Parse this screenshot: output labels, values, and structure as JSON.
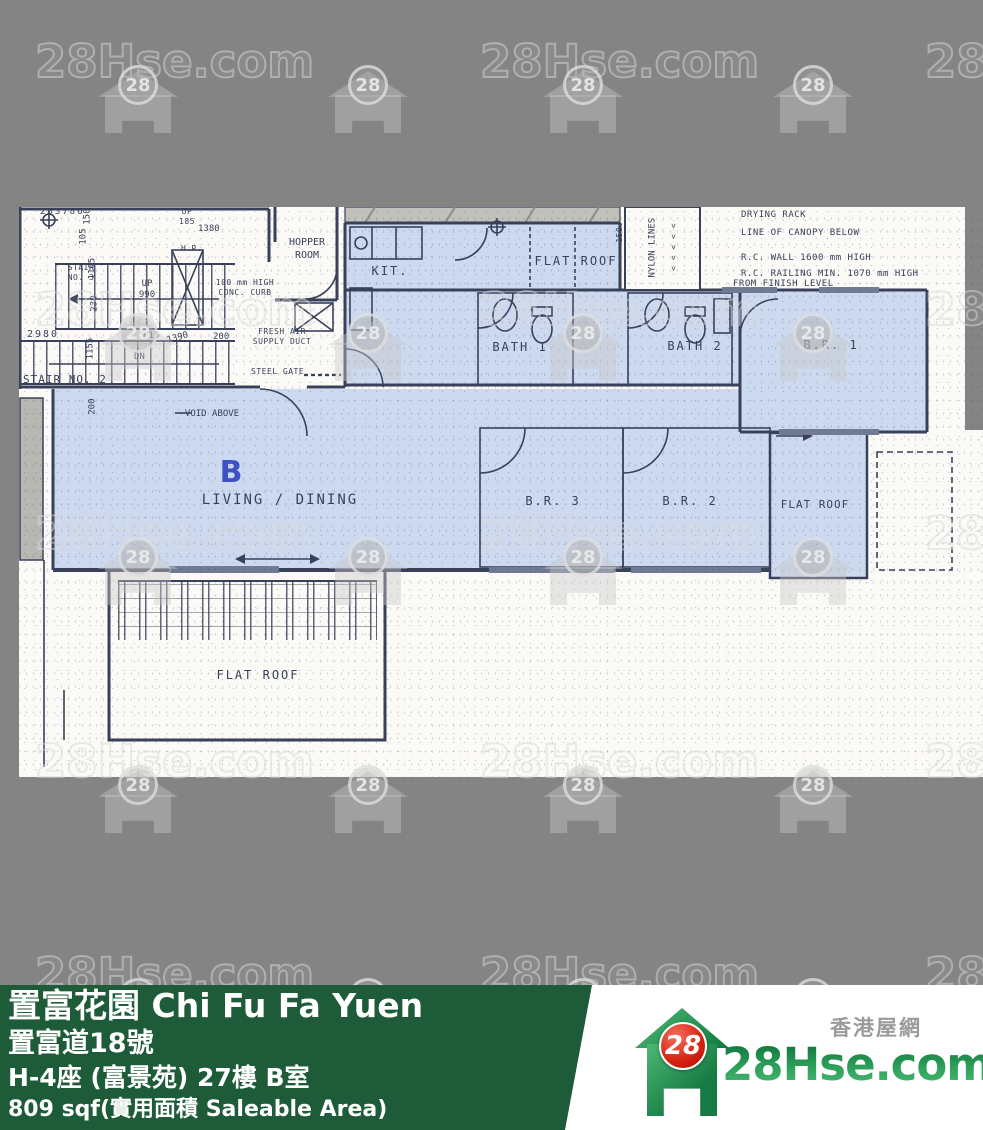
{
  "colors": {
    "background": "#848484",
    "paper": "#fbfaf6",
    "unit_highlight": "#cdd9ef",
    "ink": "#39415a",
    "footer_green": "#1e5c39",
    "unit_letter_blue": "#3d52c4",
    "logo_red": "#d6200f",
    "logo_green": "#1f8a4c"
  },
  "watermark": {
    "text": "28Hse.com",
    "badge": "28"
  },
  "plan": {
    "unit_label": "B",
    "labels": {
      "kitchen": "KIT.",
      "flat_roof_top": "FLAT ROOF",
      "bath1": "BATH 1",
      "bath2": "BATH 2",
      "br1": "B.R. 1",
      "br2": "B.R. 2",
      "br3": "B.R. 3",
      "living": "LIVING / DINING",
      "flat_roof_right": "FLAT ROOF",
      "flat_roof_bottom": "FLAT ROOF",
      "hopper_room": "HOPPER\nROOM",
      "void_above": "VOID ABOVE",
      "stair_no2": "STAIR NO. 2",
      "stair_no3": "STAIR\nNO. 3",
      "up_990": "UP\n990",
      "dn": "DN",
      "up_185": "UP\n185",
      "hr": "H.R.",
      "nylon_lines": "NYLON LINES",
      "nylon_150": "150.",
      "chevrons": "< < < < <",
      "conc_curb": "100 mm HIGH\nCONC. CURB",
      "fresh_air": "FRESH AIR\nSUPPLY DUCT",
      "steel_gate": "STEEL GATE"
    },
    "annotations": {
      "drying_rack": "DRYING RACK",
      "canopy": "LINE OF CANOPY BELOW",
      "rc_wall": "R.C. WALL 1600 mm HIGH",
      "rc_railing": "R.C. RAILING MIN. 1070 mm HIGH",
      "rc_railing_2": "FROM FINISH LEVEL"
    },
    "dims": {
      "d1": "203786",
      "d2": "150",
      "d3": "105",
      "d4": "1105",
      "d5": "230",
      "d6": "2980",
      "d7": "1155",
      "d8": "815",
      "d9": "1390",
      "d10": "200",
      "d11": "1380",
      "d12": "200"
    }
  },
  "footer": {
    "title": "置富花園 Chi Fu Fa Yuen",
    "address": "置富道18號",
    "unit": "H-4座 (富景苑) 27樓 B室",
    "area": "809 sqf(實用面積 Saleable Area)"
  },
  "logo": {
    "badge": "28",
    "site_zh": "香港屋網",
    "site_name": "28Hse.com"
  }
}
